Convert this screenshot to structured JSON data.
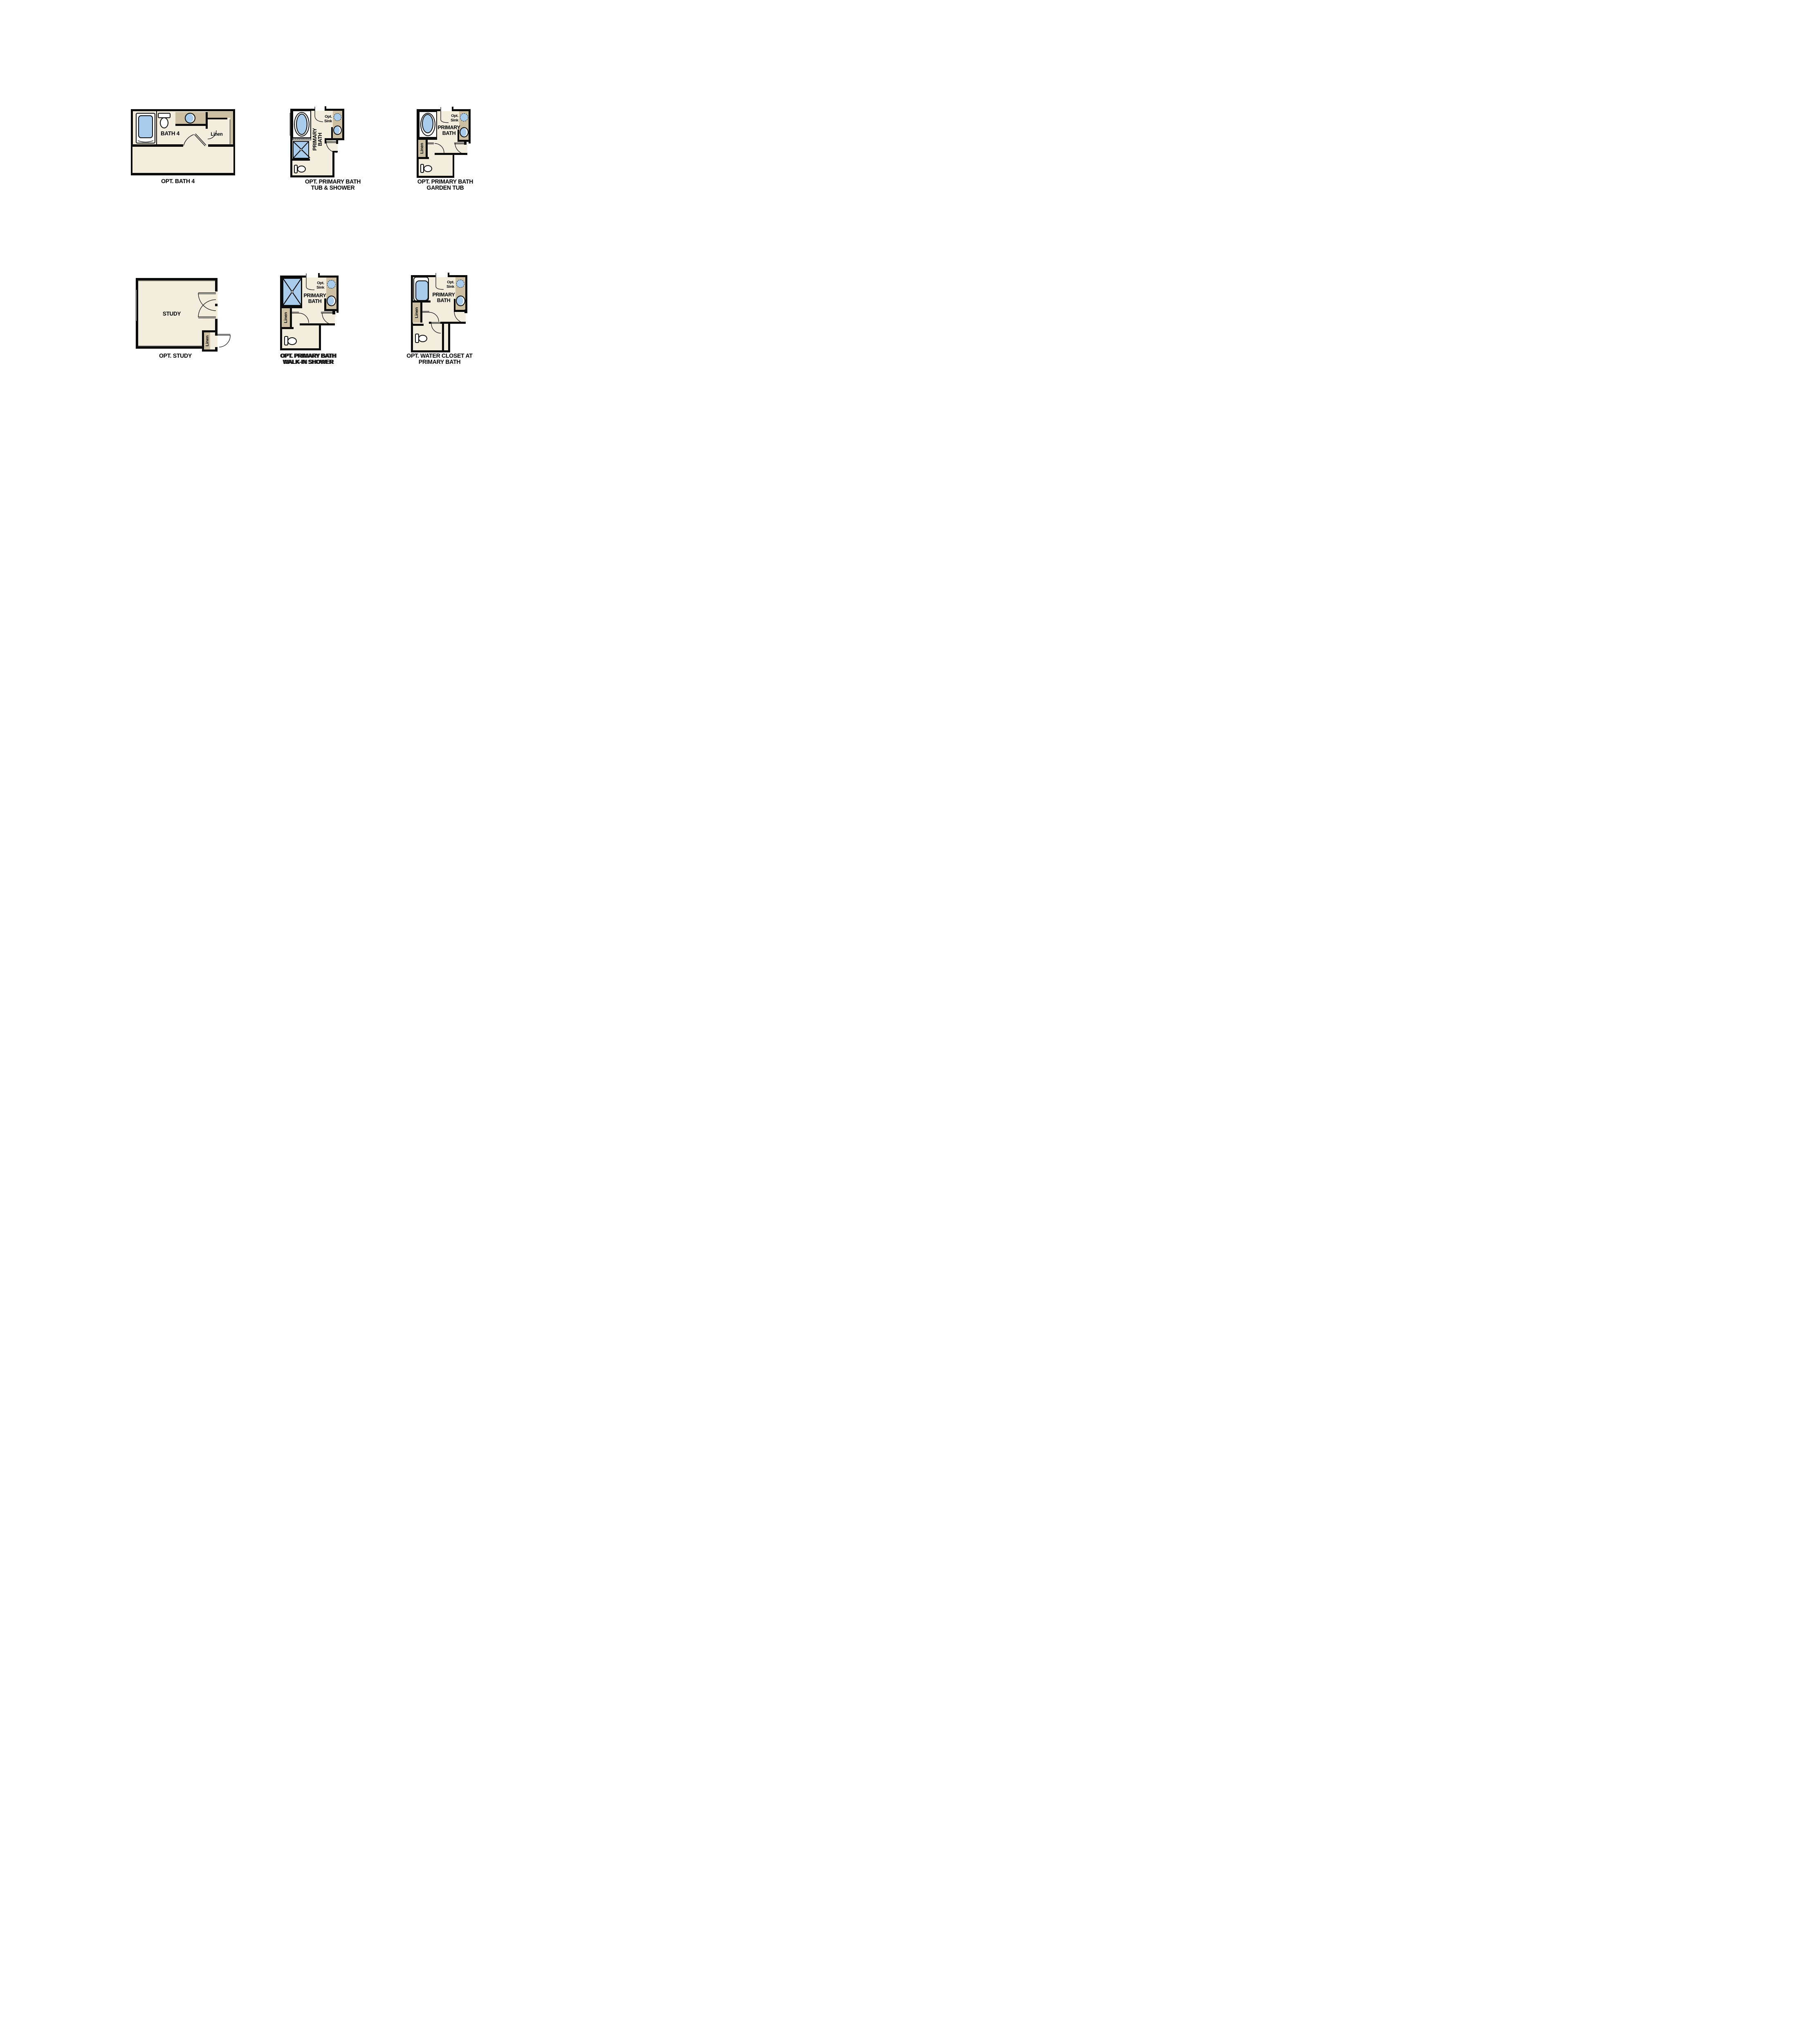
{
  "colors": {
    "wall": "#0b0b0b",
    "floor": "#f3edde",
    "counter": "#ccbfa2",
    "fixture_blue": "#a9cbec",
    "window_gray": "#8e8e8e"
  },
  "plans": [
    {
      "id": "opt-bath-4",
      "caption": "OPT. BATH 4",
      "labels": {
        "room": "BATH 4",
        "linen": "Linen"
      }
    },
    {
      "id": "opt-primary-bath-tub-shower",
      "caption_line1": "OPT. PRIMARY BATH",
      "caption_line2": "TUB & SHOWER",
      "labels": {
        "room_line1": "PRIMARY",
        "room_line2": "BATH",
        "opt_sink_line1": "Opt.",
        "opt_sink_line2": "Sink"
      }
    },
    {
      "id": "opt-primary-bath-garden-tub",
      "caption_line1": "OPT. PRIMARY BATH",
      "caption_line2": "GARDEN TUB",
      "labels": {
        "room_line1": "PRIMARY",
        "room_line2": "BATH",
        "opt_sink_line1": "Opt.",
        "opt_sink_line2": "Sink",
        "linen": "Linen"
      }
    },
    {
      "id": "opt-study",
      "caption": "OPT. STUDY",
      "labels": {
        "room": "STUDY",
        "linen": "Linen"
      }
    },
    {
      "id": "opt-primary-bath-walk-in-shower",
      "caption_line1": "OPT. PRIMARY BATH",
      "caption_line2": "WALK-IN SHOWER",
      "labels": {
        "room_line1": "PRIMARY",
        "room_line2": "BATH",
        "opt_sink_line1": "Opt.",
        "opt_sink_line2": "Sink",
        "linen": "Linen"
      }
    },
    {
      "id": "opt-water-closet-at-primary-bath",
      "caption_line1": "OPT. WATER CLOSET AT",
      "caption_line2": "PRIMARY BATH",
      "labels": {
        "room_line1": "PRIMARY",
        "room_line2": "BATH",
        "opt_sink_line1": "Opt.",
        "opt_sink_line2": "Sink",
        "linen": "Linen"
      }
    }
  ]
}
